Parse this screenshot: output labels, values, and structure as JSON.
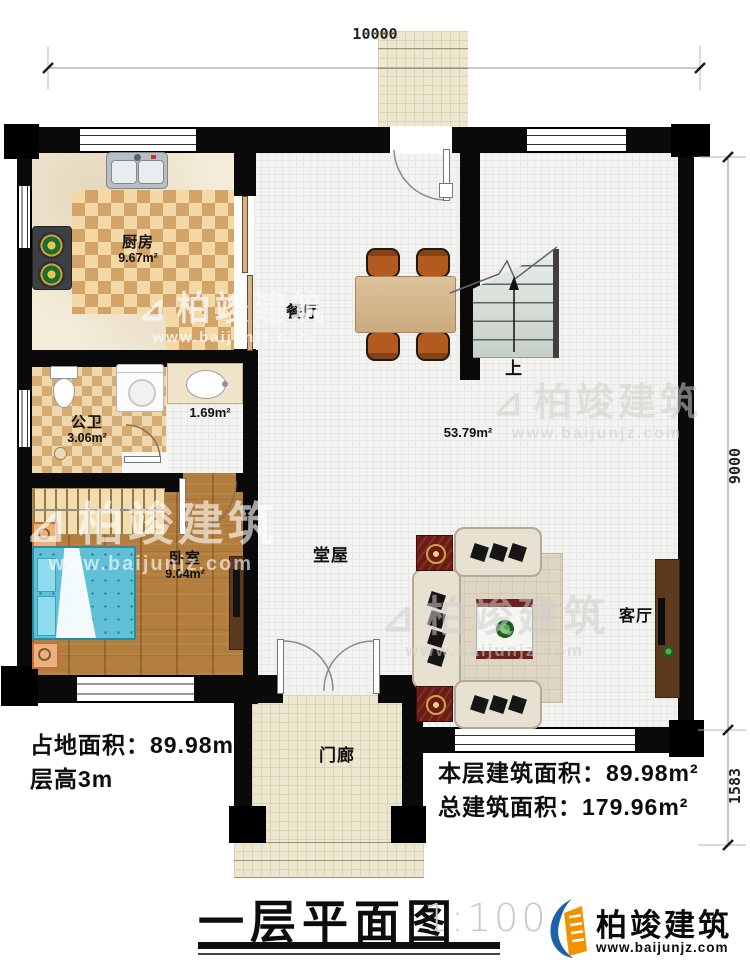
{
  "plan": {
    "dimensions": {
      "top_width": "10000",
      "right_height_main": "9000",
      "right_height_porch": "1583"
    },
    "rooms": {
      "kitchen": {
        "name": "厨房",
        "area": "9.67m²"
      },
      "dining": {
        "name": "餐厅"
      },
      "bathroom": {
        "name": "公卫",
        "area": "3.06m²"
      },
      "washroom": {
        "area": "1.69m²"
      },
      "hall": {
        "name": "堂屋",
        "area": "53.79m²"
      },
      "bedroom": {
        "name": "卧室",
        "area": "9.04m²"
      },
      "living_room": {
        "name": "客厅"
      },
      "porch": {
        "name": "门廊"
      },
      "stairs": {
        "up_label": "上"
      }
    }
  },
  "annotations": {
    "site_area": "占地面积：89.98m²",
    "floor_height": "层高3m",
    "floor_area": "本层建筑面积：89.98m²",
    "total_area": "总建筑面积：179.96m²"
  },
  "title_block": {
    "title": "一层平面图",
    "scale": "1:100"
  },
  "brand": {
    "name": "柏竣建筑",
    "url": "www.baijunjz.com"
  },
  "watermark": {
    "name": "柏竣建筑",
    "url": "www.baijunjz.com"
  },
  "icons": {
    "watermark_logo": "⊿"
  },
  "colors": {
    "accent_blue": "#1b62ab",
    "accent_orange": "#f29200",
    "wall": "#0a0a0a",
    "wood_floor": "#b27d3d",
    "tile_light": "#f4d9a6",
    "tile_dark": "#d2a468",
    "bed": "#5fc0d6"
  }
}
